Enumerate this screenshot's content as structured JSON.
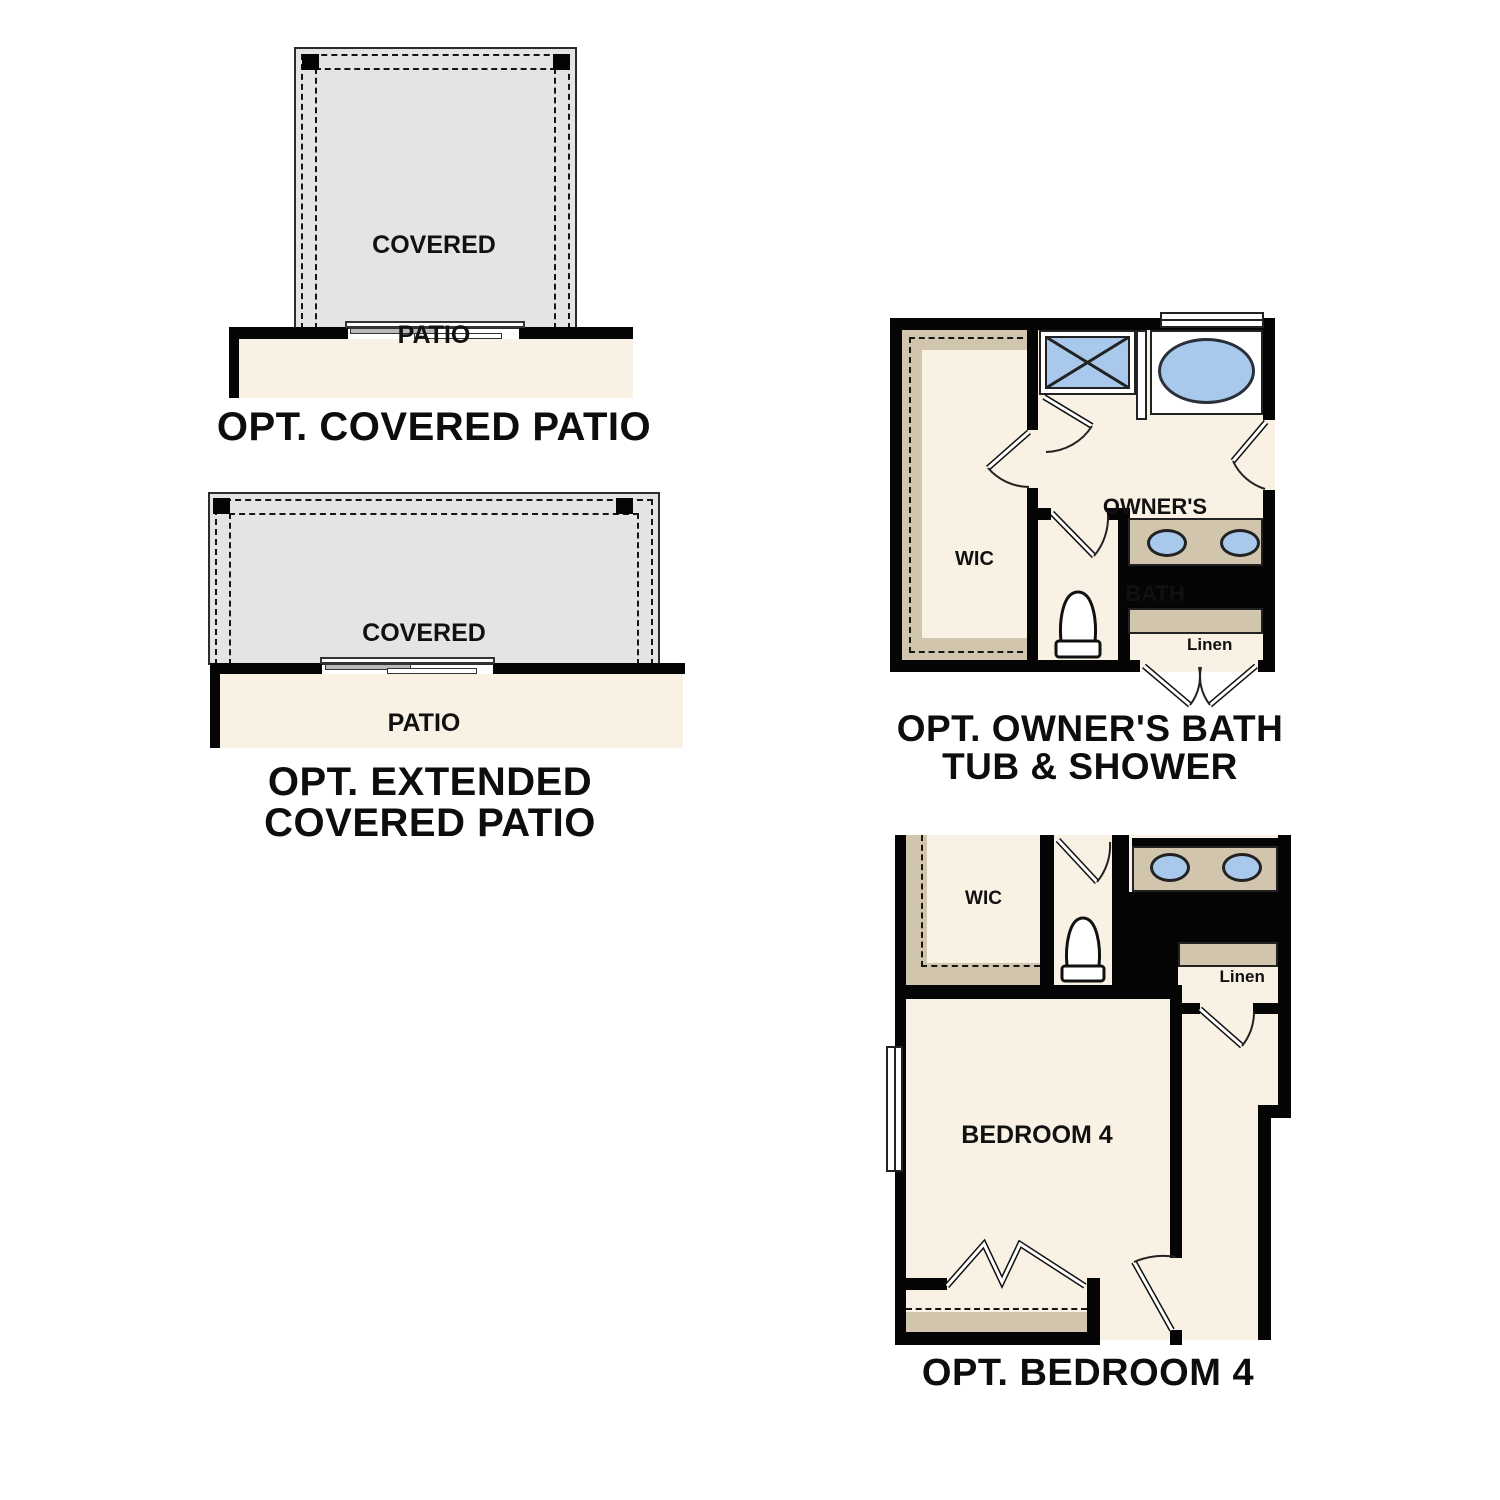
{
  "colors": {
    "wall": "#050505",
    "floor_cream": "#f8f1e4",
    "patio_gray": "#e4e4e2",
    "cabinet_tan": "#d1c6ad",
    "fixture_blue": "#a9c9ec",
    "line": "#2c2c2c"
  },
  "d1": {
    "caption": "OPT. COVERED PATIO",
    "room_line1": "COVERED",
    "room_line2": "PATIO"
  },
  "d2": {
    "caption_line1": "OPT. EXTENDED",
    "caption_line2": "COVERED PATIO",
    "room_line1": "COVERED",
    "room_line2": "PATIO"
  },
  "d3": {
    "caption_line1": "OPT. OWNER'S BATH",
    "caption_line2": "TUB & SHOWER",
    "title_line1": "OWNER'S",
    "title_line2": "BATH",
    "wic_label": "WIC",
    "linen_label": "Linen"
  },
  "d4": {
    "caption": "OPT. BEDROOM 4",
    "room_label": "BEDROOM 4",
    "wic_label": "WIC",
    "linen_label": "Linen"
  }
}
